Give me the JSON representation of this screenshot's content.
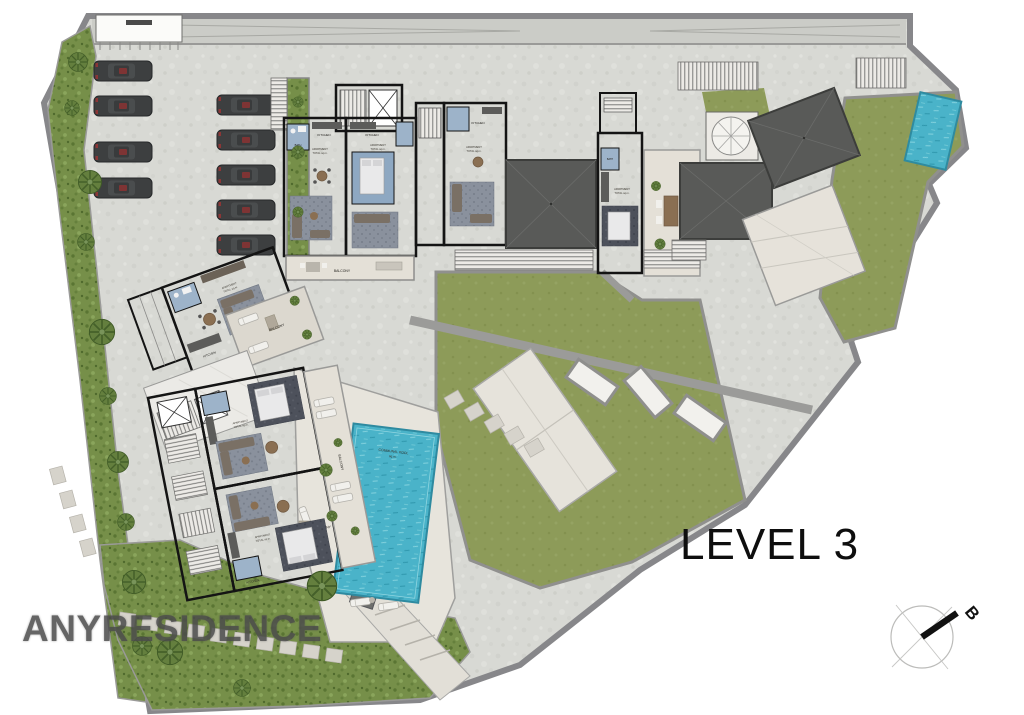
{
  "page": {
    "background": "#ffffff"
  },
  "plan": {
    "level_label": "LEVEL 3",
    "watermark": "ANYRESIDENCE",
    "compass_letter": "B"
  },
  "labels": {
    "kitchen": "KITCHEN",
    "bath": "BATH",
    "balcony": "BALCONY",
    "pool_line1": "COMMUNAL POOL",
    "pool_line2": "sq.m.",
    "unit_line1": "APARTMENT",
    "unit_line2": "TOTAL  sq.m."
  },
  "parking": {
    "left_column_cars": 4,
    "right_column_cars": 5,
    "total_cars": 9
  },
  "colors": {
    "concrete": "#d8d9d4",
    "road": "#cbccc7",
    "boundary_wall": "#87878a",
    "lawn": "#8d9b59",
    "shrub": "#768f49",
    "water": "#4ab3c9",
    "roof_void": "#595a58",
    "wood_floor": "#dcc9ab",
    "terrace": "#e4e0d7",
    "bath_blue": "#9db3c9",
    "wall_black": "#141414",
    "car_body": "#3d3f40",
    "watermark_gray": "#4b4b4b"
  }
}
